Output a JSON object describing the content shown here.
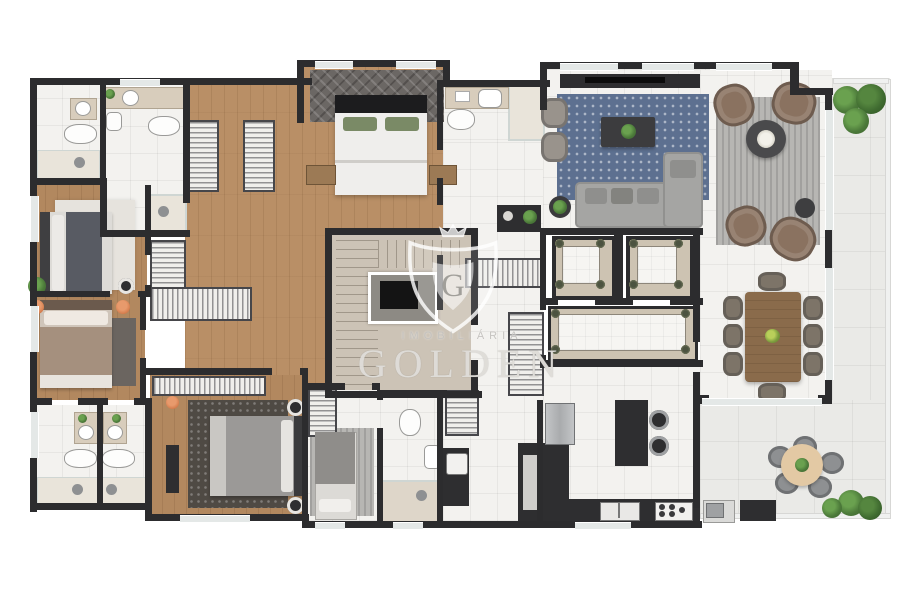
{
  "watermark": {
    "top_line": "IMOBILIÁRIA",
    "name": "GOLDEN",
    "monogram": "G"
  },
  "palette": {
    "wall": "#2c2c2e",
    "wood_floor": "#b98f66",
    "white_tile": "#f3f2ef",
    "terrace_tile": "#eaeae7",
    "stair_floor": "#ccc3b6",
    "elevator_frame": "#cdc3b2",
    "rug_blue": "#5d7090",
    "rug_gray": "#b7b6b3",
    "sofa_gray": "#a5a5a3",
    "armchair_brown": "#8a7260",
    "dining_table_wood": "#8a6b4b",
    "counter_dark": "#2e2e30",
    "plant_green": "#4c7a3a",
    "accent_pillow_green": "#7a8a66",
    "watermark_white": "rgba(255,255,255,0.8)"
  }
}
